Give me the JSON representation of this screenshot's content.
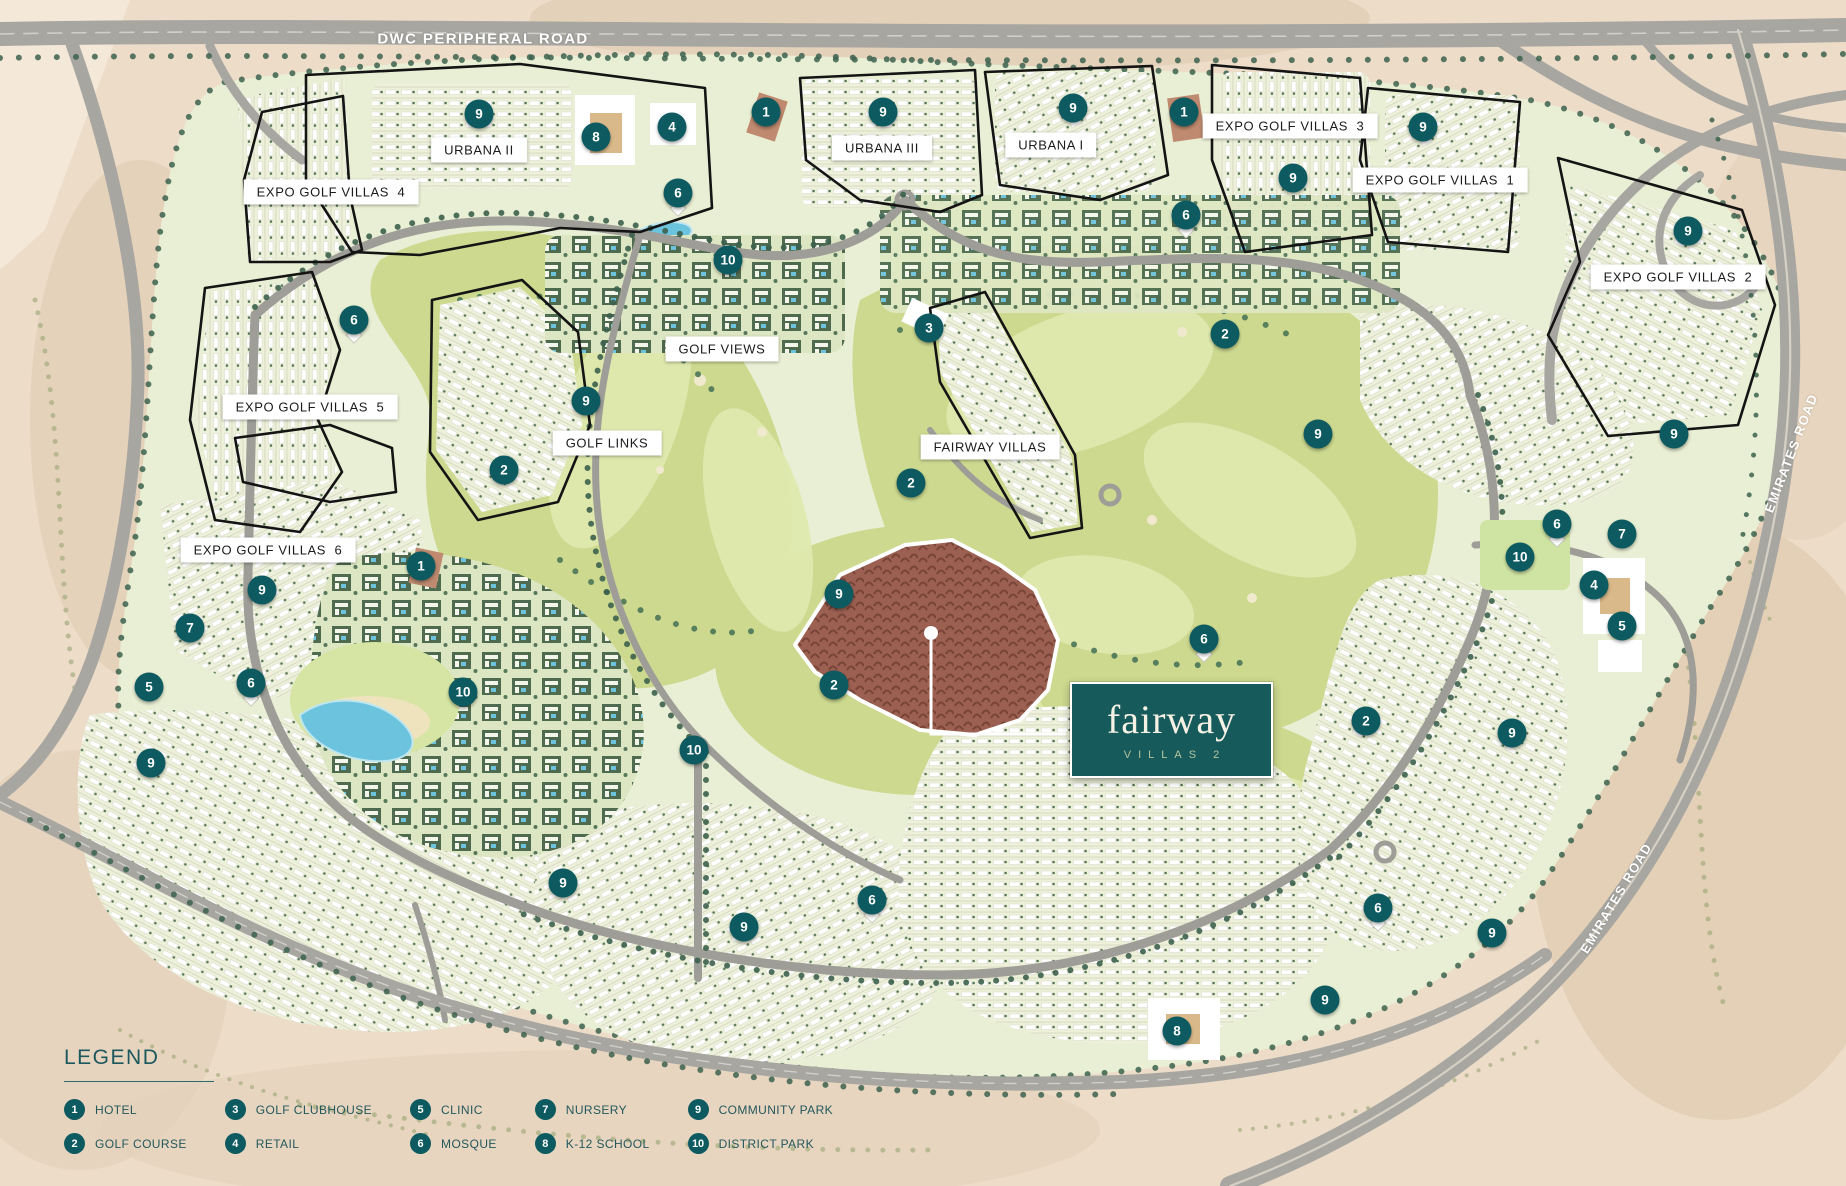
{
  "title": "Fairway Villas 2 masterplan map",
  "colors": {
    "marker_teal": "#0d5a60",
    "logo_teal": "#175a5c",
    "legend_text": "#24585c",
    "sand": "#ecdcc8",
    "community_green": "#e9efd4",
    "golf_green": "#ccd98f",
    "site_brown": "#9c6052",
    "road_grey": "#a7a6a1"
  },
  "map": {
    "roads": {
      "dwc": "DWC PERIPHERAL ROAD",
      "emirates_top": "EMIRATES ROAD",
      "emirates_bottom": "EMIRATES ROAD"
    },
    "site_logo": {
      "line1": "fairway",
      "line2": "VILLAS 2"
    },
    "area_labels": [
      {
        "text": "EXPO GOLF VILLAS  4",
        "x": 331,
        "y": 192
      },
      {
        "text": "URBANA II",
        "x": 479,
        "y": 150
      },
      {
        "text": "URBANA III",
        "x": 882,
        "y": 148
      },
      {
        "text": "URBANA I",
        "x": 1051,
        "y": 145
      },
      {
        "text": "EXPO GOLF VILLAS  3",
        "x": 1290,
        "y": 126
      },
      {
        "text": "EXPO GOLF VILLAS  1",
        "x": 1440,
        "y": 180
      },
      {
        "text": "EXPO GOLF VILLAS  2",
        "x": 1678,
        "y": 277
      },
      {
        "text": "GOLF VIEWS",
        "x": 722,
        "y": 349
      },
      {
        "text": "GOLF LINKS",
        "x": 607,
        "y": 443
      },
      {
        "text": "FAIRWAY VILLAS",
        "x": 990,
        "y": 447
      },
      {
        "text": "EXPO GOLF VILLAS  5",
        "x": 310,
        "y": 407
      },
      {
        "text": "EXPO GOLF VILLAS  6",
        "x": 268,
        "y": 550
      }
    ],
    "markers": [
      {
        "n": 9,
        "x": 479,
        "y": 114
      },
      {
        "n": 8,
        "x": 596,
        "y": 137
      },
      {
        "n": 4,
        "x": 672,
        "y": 127
      },
      {
        "n": 6,
        "x": 678,
        "y": 193
      },
      {
        "n": 1,
        "x": 766,
        "y": 112
      },
      {
        "n": 9,
        "x": 883,
        "y": 112
      },
      {
        "n": 9,
        "x": 1073,
        "y": 108
      },
      {
        "n": 1,
        "x": 1184,
        "y": 112
      },
      {
        "n": 6,
        "x": 1186,
        "y": 215
      },
      {
        "n": 9,
        "x": 1293,
        "y": 178
      },
      {
        "n": 9,
        "x": 1423,
        "y": 127
      },
      {
        "n": 9,
        "x": 1688,
        "y": 231
      },
      {
        "n": 10,
        "x": 728,
        "y": 260
      },
      {
        "n": 6,
        "x": 354,
        "y": 320
      },
      {
        "n": 3,
        "x": 929,
        "y": 328
      },
      {
        "n": 2,
        "x": 1225,
        "y": 334
      },
      {
        "n": 9,
        "x": 586,
        "y": 401
      },
      {
        "n": 2,
        "x": 504,
        "y": 470
      },
      {
        "n": 9,
        "x": 1318,
        "y": 434
      },
      {
        "n": 9,
        "x": 1674,
        "y": 434
      },
      {
        "n": 2,
        "x": 911,
        "y": 483
      },
      {
        "n": 9,
        "x": 262,
        "y": 590
      },
      {
        "n": 1,
        "x": 421,
        "y": 566
      },
      {
        "n": 7,
        "x": 190,
        "y": 628
      },
      {
        "n": 5,
        "x": 149,
        "y": 687
      },
      {
        "n": 6,
        "x": 251,
        "y": 683
      },
      {
        "n": 10,
        "x": 463,
        "y": 692
      },
      {
        "n": 9,
        "x": 151,
        "y": 763
      },
      {
        "n": 9,
        "x": 839,
        "y": 594
      },
      {
        "n": 2,
        "x": 834,
        "y": 685
      },
      {
        "n": 10,
        "x": 694,
        "y": 750
      },
      {
        "n": 6,
        "x": 1204,
        "y": 639
      },
      {
        "n": 2,
        "x": 1366,
        "y": 721
      },
      {
        "n": 9,
        "x": 1512,
        "y": 733
      },
      {
        "n": 6,
        "x": 1557,
        "y": 524
      },
      {
        "n": 7,
        "x": 1622,
        "y": 534
      },
      {
        "n": 10,
        "x": 1520,
        "y": 557
      },
      {
        "n": 4,
        "x": 1594,
        "y": 585
      },
      {
        "n": 5,
        "x": 1622,
        "y": 626
      },
      {
        "n": 9,
        "x": 563,
        "y": 883
      },
      {
        "n": 6,
        "x": 872,
        "y": 900
      },
      {
        "n": 9,
        "x": 744,
        "y": 927
      },
      {
        "n": 6,
        "x": 1378,
        "y": 908
      },
      {
        "n": 9,
        "x": 1492,
        "y": 933
      },
      {
        "n": 9,
        "x": 1325,
        "y": 1000
      },
      {
        "n": 8,
        "x": 1177,
        "y": 1031
      }
    ]
  },
  "legend": {
    "title": "LEGEND",
    "items": [
      {
        "n": 1,
        "label": "HOTEL"
      },
      {
        "n": 2,
        "label": "GOLF COURSE"
      },
      {
        "n": 3,
        "label": "GOLF CLUBHOUSE"
      },
      {
        "n": 4,
        "label": "RETAIL"
      },
      {
        "n": 5,
        "label": "CLINIC"
      },
      {
        "n": 6,
        "label": "MOSQUE"
      },
      {
        "n": 7,
        "label": "NURSERY"
      },
      {
        "n": 8,
        "label": "K-12 SCHOOL"
      },
      {
        "n": 9,
        "label": "COMMUNITY PARK"
      },
      {
        "n": 10,
        "label": "DISTRICT PARK"
      }
    ]
  }
}
